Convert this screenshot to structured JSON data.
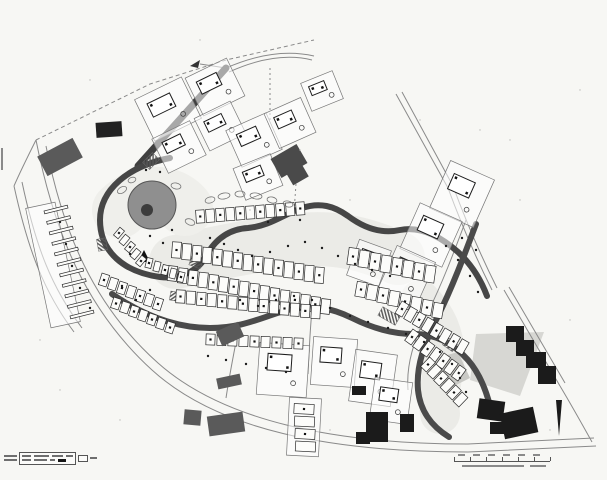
{
  "document": {
    "kind": "scanned urban development site plan, black ink on white paper",
    "legible_text": "none (all annotations are below legibility at this scan size)"
  },
  "colors": {
    "paper": "#f7f7f4",
    "ink": "#2a2a2a",
    "road_band": "#464646",
    "existing_building_black": "#1b1b1b",
    "existing_building_gray": "#5a5a5a",
    "pond_gray": "#8f8f8f",
    "underlay": "#ebebe7",
    "thin_line": "#8a8a8a"
  },
  "footer": {
    "legend": {
      "left_label_widths": [
        13,
        13
      ],
      "row1_bar_widths": [
        9,
        15,
        11,
        7
      ],
      "row2_bar_widths": [
        9,
        13,
        5
      ],
      "has_black_swatch": true,
      "tail_bar_width": 7
    },
    "scale_bar": {
      "segments": 6,
      "segment_px": 16,
      "top_mark_widths": [
        7,
        7,
        7,
        7,
        7,
        7
      ],
      "caption_bar_widths": [
        62,
        16
      ]
    }
  },
  "map": {
    "underlays": [
      {
        "d": "M 176,262 C 220,252 260,244 300,240 C 340,236 370,246 398,258",
        "w": 54,
        "c": "#ebebe7"
      },
      {
        "d": "M 420,300 C 436,316 446,336 444,360 C 442,380 438,398 440,414",
        "w": 40,
        "c": "#ebebe7"
      },
      {
        "d": "M 120,210 C 140,190 170,190 185,208",
        "w": 56,
        "c": "#efefeb"
      }
    ],
    "bands": [
      {
        "d": "M 138,166 L 226,68",
        "w": 7,
        "c": "#3f3f3f"
      },
      {
        "d": "M 170,158 C 128,166 100,190 100,220 C 100,252 124,272 160,277 C 184,280 200,268 206,256",
        "w": 6,
        "c": "#464646"
      },
      {
        "d": "M 206,256 C 216,238 230,229 248,228 C 270,226 284,214 302,208 C 320,202 334,206 348,216 C 364,228 382,234 400,230 C 420,226 440,236 458,252 C 472,265 481,280 487,296",
        "w": 6,
        "c": "#464646"
      },
      {
        "d": "M 112,294 C 144,316 176,328 210,328 C 244,328 264,316 288,310 C 312,304 332,308 352,318 C 372,328 392,334 414,334 C 436,334 454,344 468,360 C 480,374 486,390 490,406",
        "w": 6,
        "c": "#4a4a4a"
      },
      {
        "d": "M 476,224 C 464,256 452,288 438,316 C 424,344 416,366 418,390 C 420,410 431,426 449,437",
        "w": 6,
        "c": "#4a4a4a"
      }
    ],
    "thin": [
      {
        "d": "M 226,68 C 258,54 288,50 314,56"
      },
      {
        "d": "M 229,72 C 260,58 288,54 312,60"
      },
      {
        "d": "M 226,68 L 200,64"
      },
      {
        "d": "M 396,94 L 448,188 C 462,226 476,258 492,290"
      },
      {
        "d": "M 402,92 L 453,186 C 467,224 481,256 497,288"
      },
      {
        "d": "M 504,290 L 560,386"
      },
      {
        "d": "M 509,287 L 565,383"
      },
      {
        "d": "M 36,140 C 54,232 86,310 152,370 C 218,430 330,452 468,452 L 596,446"
      },
      {
        "d": "M 46,146 C 63,233 94,306 158,363 C 222,420 332,444 468,444 L 594,438"
      },
      {
        "d": "M 14,186 C 28,250 44,292 74,332"
      },
      {
        "d": "M 22,182 C 36,248 52,288 82,328"
      },
      {
        "d": "M 36,140 C 28,156 20,172 14,186"
      },
      {
        "d": "M 560,386 C 572,406 582,424 592,442"
      },
      {
        "d": "M 466,220 C 454,252 442,284 428,312 C 414,340 406,364 408,390"
      },
      {
        "d": "M 36,140 L 150,84 L 226,60 L 314,40",
        "dash": "4,3"
      },
      {
        "d": "M 270,68 L 270,122",
        "dash": "2,3"
      },
      {
        "d": "M 296,184 L 294,212",
        "dash": "2,3"
      },
      {
        "d": "M 226,398 C 230,372 234,352 238,332"
      },
      {
        "d": "M 308,374 C 309,352 310,330 312,310"
      },
      {
        "d": "M 2,148 L 2,170",
        "w": 2
      }
    ],
    "rows": [
      {
        "x": 196,
        "y": 210,
        "dx": 10,
        "dy": -0.8,
        "count": 11,
        "w": 8.5,
        "h": 13,
        "rot": -4
      },
      {
        "x": 172,
        "y": 242,
        "dx": 10.2,
        "dy": 1.8,
        "count": 15,
        "w": 9,
        "h": 16,
        "rot": 4
      },
      {
        "x": 168,
        "y": 266,
        "dx": 10.2,
        "dy": 2.2,
        "count": 16,
        "w": 9,
        "h": 15,
        "rot": 6
      },
      {
        "x": 176,
        "y": 290,
        "dx": 10.4,
        "dy": 1.2,
        "count": 14,
        "w": 9,
        "h": 13,
        "rot": 3
      },
      {
        "x": 348,
        "y": 248,
        "dx": 11,
        "dy": 2.5,
        "count": 8,
        "w": 10,
        "h": 17,
        "rot": 8
      },
      {
        "x": 356,
        "y": 282,
        "dx": 11,
        "dy": 3,
        "count": 8,
        "w": 10,
        "h": 15,
        "rot": 10
      },
      {
        "x": 398,
        "y": 302,
        "dx": 8.6,
        "dy": 5.4,
        "count": 8,
        "w": 8,
        "h": 14,
        "rot": 30
      },
      {
        "x": 408,
        "y": 330,
        "dx": 7.8,
        "dy": 6,
        "count": 7,
        "w": 8,
        "h": 14,
        "rot": 36
      },
      {
        "x": 424,
        "y": 358,
        "dx": 6.5,
        "dy": 7,
        "count": 6,
        "w": 8,
        "h": 13,
        "rot": 44
      },
      {
        "x": 116,
        "y": 228,
        "dx": 5.5,
        "dy": 7,
        "count": 5,
        "w": 6,
        "h": 10,
        "rot": 40
      },
      {
        "x": 146,
        "y": 258,
        "dx": 8,
        "dy": 3.5,
        "count": 5,
        "w": 6,
        "h": 10,
        "rot": 14
      },
      {
        "x": 100,
        "y": 274,
        "dx": 9,
        "dy": 4,
        "count": 7,
        "w": 8,
        "h": 12,
        "rot": 18
      },
      {
        "x": 112,
        "y": 298,
        "dx": 9,
        "dy": 4,
        "count": 7,
        "w": 8,
        "h": 11,
        "rot": 18
      },
      {
        "x": 206,
        "y": 334,
        "dx": 11,
        "dy": 0.5,
        "count": 9,
        "w": 9,
        "h": 11,
        "rot": 2
      },
      {
        "x": 44,
        "y": 208,
        "dx": 2.6,
        "dy": 10.5,
        "count": 11,
        "w": 24,
        "h": 3,
        "rot": -14
      },
      {
        "x": 294,
        "y": 404,
        "dx": 0.5,
        "dy": 12.5,
        "count": 4,
        "w": 20,
        "h": 10,
        "rot": 3
      }
    ],
    "plots": [
      {
        "x": 142,
        "y": 86,
        "w": 52,
        "h": 46,
        "rot": -26
      },
      {
        "x": 192,
        "y": 66,
        "w": 46,
        "h": 42,
        "rot": -26
      },
      {
        "x": 158,
        "y": 128,
        "w": 42,
        "h": 38,
        "rot": -26
      },
      {
        "x": 200,
        "y": 108,
        "w": 40,
        "h": 36,
        "rot": -26
      },
      {
        "x": 232,
        "y": 120,
        "w": 44,
        "h": 40,
        "rot": -24
      },
      {
        "x": 270,
        "y": 104,
        "w": 40,
        "h": 38,
        "rot": -24
      },
      {
        "x": 238,
        "y": 160,
        "w": 40,
        "h": 34,
        "rot": -22
      },
      {
        "x": 305,
        "y": 76,
        "w": 34,
        "h": 30,
        "rot": -22
      },
      {
        "x": 438,
        "y": 168,
        "w": 48,
        "h": 52,
        "rot": 24
      },
      {
        "x": 408,
        "y": 210,
        "w": 46,
        "h": 50,
        "rot": 24
      },
      {
        "x": 386,
        "y": 252,
        "w": 42,
        "h": 46,
        "rot": 24
      },
      {
        "x": 352,
        "y": 244,
        "w": 34,
        "h": 38,
        "rot": 20
      },
      {
        "x": 258,
        "y": 344,
        "w": 50,
        "h": 52,
        "rot": 4
      },
      {
        "x": 312,
        "y": 338,
        "w": 44,
        "h": 48,
        "rot": 4
      },
      {
        "x": 352,
        "y": 352,
        "w": 42,
        "h": 52,
        "rot": 8
      },
      {
        "x": 372,
        "y": 380,
        "w": 38,
        "h": 42,
        "rot": 8
      },
      {
        "x": 288,
        "y": 398,
        "w": 32,
        "h": 58,
        "rot": 3,
        "empty": true
      },
      {
        "x": 38,
        "y": 204,
        "w": 30,
        "h": 122,
        "rot": -12,
        "empty": true
      }
    ],
    "buildings": [
      {
        "x": 40,
        "y": 146,
        "w": 40,
        "h": 22,
        "rot": -28,
        "c": "#5a5a5a"
      },
      {
        "x": 96,
        "y": 122,
        "w": 26,
        "h": 15,
        "rot": -4,
        "c": "#222222"
      },
      {
        "x": 274,
        "y": 150,
        "w": 30,
        "h": 22,
        "rot": -30,
        "c": "#4a4a4a"
      },
      {
        "x": 288,
        "y": 166,
        "w": 18,
        "h": 16,
        "rot": -30,
        "c": "#4a4a4a"
      },
      {
        "x": 506,
        "y": 326,
        "w": 18,
        "h": 16,
        "rot": 0,
        "c": "#1b1b1b"
      },
      {
        "x": 516,
        "y": 340,
        "w": 18,
        "h": 16,
        "rot": 0,
        "c": "#1b1b1b"
      },
      {
        "x": 526,
        "y": 352,
        "w": 20,
        "h": 16,
        "rot": 0,
        "c": "#1b1b1b"
      },
      {
        "x": 538,
        "y": 366,
        "w": 18,
        "h": 18,
        "rot": 0,
        "c": "#1b1b1b"
      },
      {
        "x": 478,
        "y": 400,
        "w": 26,
        "h": 20,
        "rot": 8,
        "c": "#1b1b1b"
      },
      {
        "x": 502,
        "y": 410,
        "w": 34,
        "h": 26,
        "rot": -12,
        "c": "#1b1b1b"
      },
      {
        "x": 490,
        "y": 422,
        "w": 16,
        "h": 12,
        "rot": 0,
        "c": "#1b1b1b"
      },
      {
        "x": 400,
        "y": 414,
        "w": 14,
        "h": 18,
        "rot": 0,
        "c": "#1b1b1b"
      },
      {
        "x": 366,
        "y": 412,
        "w": 22,
        "h": 30,
        "rot": 0,
        "c": "#1b1b1b"
      },
      {
        "x": 356,
        "y": 432,
        "w": 14,
        "h": 12,
        "rot": 0,
        "c": "#1b1b1b"
      },
      {
        "x": 352,
        "y": 386,
        "w": 14,
        "h": 9,
        "rot": 0,
        "c": "#1b1b1b"
      },
      {
        "x": 218,
        "y": 326,
        "w": 24,
        "h": 16,
        "rot": -24,
        "c": "#5a5a5a"
      },
      {
        "x": 217,
        "y": 376,
        "w": 24,
        "h": 11,
        "rot": -12,
        "c": "#5a5a5a"
      },
      {
        "x": 184,
        "y": 410,
        "w": 17,
        "h": 15,
        "rot": 5,
        "c": "#5a5a5a"
      },
      {
        "x": 208,
        "y": 414,
        "w": 36,
        "h": 20,
        "rot": -8,
        "c": "#5a5a5a"
      }
    ],
    "wedges": [
      {
        "pts": "476,334 544,332 520,396 470,380",
        "c": "#d7d7d3"
      },
      {
        "pts": "430,360 458,352 470,378 446,390",
        "c": "#c9c9c5"
      },
      {
        "pts": "556,400 562,400 559,436",
        "c": "#1b1b1b"
      },
      {
        "pts": "138,262 150,262 144,250",
        "c": "#111111"
      },
      {
        "pts": "190,66 200,60 198,68",
        "c": "#333333"
      }
    ],
    "hatches": [
      {
        "x": 144,
        "y": 156,
        "w": 14,
        "h": 10,
        "rot": -45
      },
      {
        "x": 190,
        "y": 258,
        "w": 12,
        "h": 9,
        "rot": 20
      },
      {
        "x": 170,
        "y": 292,
        "w": 12,
        "h": 9,
        "rot": 10
      },
      {
        "x": 96,
        "y": 240,
        "w": 12,
        "h": 9,
        "rot": 80
      },
      {
        "x": 384,
        "y": 306,
        "w": 10,
        "h": 20,
        "rot": -60
      },
      {
        "x": 444,
        "y": 340,
        "w": 12,
        "h": 9,
        "rot": 35
      }
    ],
    "pond": {
      "cx": 152,
      "cy": 205,
      "r": 24,
      "icx": 147,
      "icy": 210,
      "ir": 6
    },
    "squiggles": [
      {
        "cx": 210,
        "cy": 200,
        "rx": 5,
        "ry": 3,
        "rot": -15
      },
      {
        "cx": 224,
        "cy": 196,
        "rx": 6,
        "ry": 3,
        "rot": -10
      },
      {
        "cx": 240,
        "cy": 194,
        "rx": 5,
        "ry": 3,
        "rot": 0
      },
      {
        "cx": 256,
        "cy": 196,
        "rx": 6,
        "ry": 3,
        "rot": 8
      },
      {
        "cx": 272,
        "cy": 200,
        "rx": 5,
        "ry": 3,
        "rot": 12
      },
      {
        "cx": 288,
        "cy": 204,
        "rx": 5,
        "ry": 3,
        "rot": 14
      },
      {
        "cx": 122,
        "cy": 190,
        "rx": 5,
        "ry": 3,
        "rot": -30
      },
      {
        "cx": 132,
        "cy": 180,
        "rx": 4,
        "ry": 2.6,
        "rot": -20
      },
      {
        "cx": 176,
        "cy": 186,
        "rx": 5,
        "ry": 3,
        "rot": 10
      },
      {
        "cx": 190,
        "cy": 222,
        "rx": 5,
        "ry": 3,
        "rot": 20
      }
    ],
    "dots": [
      [
        150,
        236
      ],
      [
        163,
        243
      ],
      [
        210,
        238
      ],
      [
        224,
        244
      ],
      [
        238,
        250
      ],
      [
        252,
        256
      ],
      [
        270,
        252
      ],
      [
        288,
        246
      ],
      [
        305,
        242
      ],
      [
        322,
        248
      ],
      [
        338,
        256
      ],
      [
        355,
        264
      ],
      [
        372,
        270
      ],
      [
        390,
        276
      ],
      [
        150,
        290
      ],
      [
        136,
        300
      ],
      [
        122,
        286
      ],
      [
        240,
        300
      ],
      [
        258,
        306
      ],
      [
        276,
        300
      ],
      [
        294,
        296
      ],
      [
        312,
        300
      ],
      [
        330,
        308
      ],
      [
        350,
        316
      ],
      [
        368,
        322
      ],
      [
        388,
        328
      ],
      [
        406,
        334
      ],
      [
        424,
        342
      ],
      [
        440,
        352
      ],
      [
        452,
        364
      ],
      [
        460,
        378
      ],
      [
        466,
        392
      ],
      [
        300,
        220
      ],
      [
        268,
        222
      ],
      [
        446,
        246
      ],
      [
        458,
        260
      ],
      [
        470,
        276
      ],
      [
        478,
        292
      ],
      [
        60,
        222
      ],
      [
        66,
        244
      ],
      [
        72,
        266
      ],
      [
        80,
        288
      ],
      [
        90,
        308
      ],
      [
        208,
        356
      ],
      [
        226,
        360
      ],
      [
        246,
        364
      ],
      [
        266,
        368
      ],
      [
        286,
        372
      ],
      [
        462,
        238
      ],
      [
        476,
        250
      ],
      [
        160,
        172
      ],
      [
        146,
        170
      ],
      [
        172,
        230
      ],
      [
        130,
        254
      ]
    ],
    "speckles": [
      [
        420,
        120
      ],
      [
        520,
        200
      ],
      [
        90,
        80
      ],
      [
        300,
        150
      ],
      [
        510,
        140
      ],
      [
        60,
        390
      ],
      [
        350,
        200
      ],
      [
        250,
        210
      ],
      [
        480,
        130
      ],
      [
        570,
        320
      ],
      [
        40,
        340
      ],
      [
        330,
        430
      ],
      [
        550,
        430
      ],
      [
        120,
        420
      ],
      [
        580,
        90
      ],
      [
        200,
        40
      ]
    ]
  }
}
